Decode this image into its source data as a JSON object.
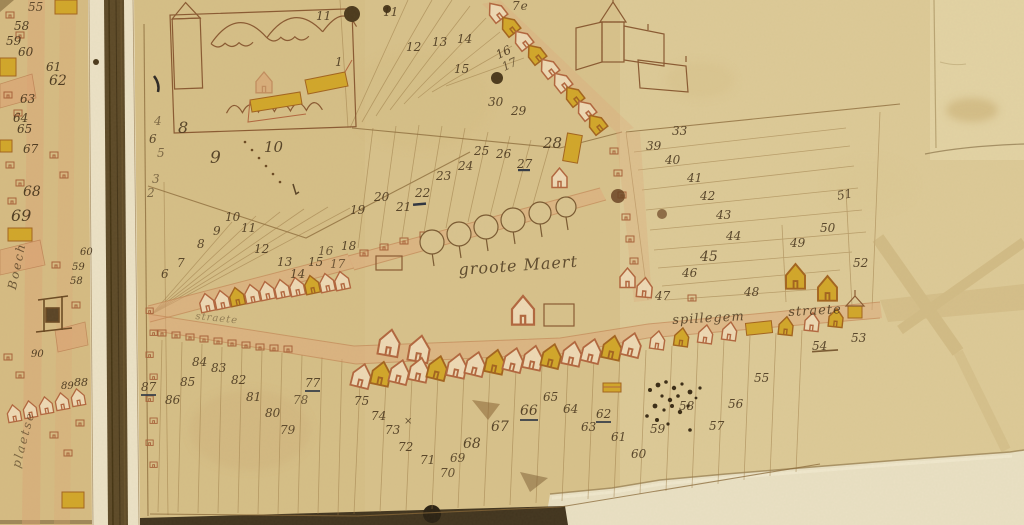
{
  "map": {
    "kind": "manuscript-cadastral-map",
    "labels": [
      {
        "t": "groote Maert",
        "x": 458,
        "y": 262,
        "s": 16,
        "r": -4,
        "cls": "pl"
      },
      {
        "t": "spillegem",
        "x": 672,
        "y": 314,
        "s": 13,
        "r": -3,
        "cls": "pl"
      },
      {
        "t": "straete",
        "x": 788,
        "y": 306,
        "s": 13,
        "r": -3,
        "cls": "pl"
      },
      {
        "t": "straete",
        "x": 196,
        "y": 312,
        "s": 10,
        "r": 6,
        "o": 0.45,
        "cls": "pl"
      },
      {
        "t": "Boech",
        "x": 6,
        "y": 288,
        "s": 12,
        "r": -78,
        "cls": "plv"
      },
      {
        "t": "plaetse",
        "x": 10,
        "y": 466,
        "s": 12,
        "r": -75,
        "o": 0.6,
        "cls": "plv"
      },
      {
        "t": "7e",
        "x": 512,
        "y": 0,
        "s": 12,
        "cls": "pl"
      },
      {
        "t": "1",
        "x": 335,
        "y": 56
      },
      {
        "t": "6",
        "x": 149,
        "y": 133
      },
      {
        "t": "4",
        "x": 154,
        "y": 115,
        "o": 0.6
      },
      {
        "t": "5",
        "x": 157,
        "y": 147,
        "o": 0.6
      },
      {
        "t": "3",
        "x": 152,
        "y": 173,
        "o": 0.6
      },
      {
        "t": "2",
        "x": 147,
        "y": 187,
        "o": 0.6
      },
      {
        "t": "8",
        "x": 178,
        "y": 120,
        "s": 16
      },
      {
        "t": "9",
        "x": 210,
        "y": 150,
        "s": 17
      },
      {
        "t": "10",
        "x": 264,
        "y": 140,
        "s": 15
      },
      {
        "t": "7",
        "x": 177,
        "y": 257
      },
      {
        "t": "6",
        "x": 161,
        "y": 268
      },
      {
        "t": "8",
        "x": 197,
        "y": 238
      },
      {
        "t": "9",
        "x": 213,
        "y": 225
      },
      {
        "t": "10",
        "x": 225,
        "y": 211
      },
      {
        "t": "11",
        "x": 241,
        "y": 222
      },
      {
        "t": "12",
        "x": 254,
        "y": 243
      },
      {
        "t": "13",
        "x": 277,
        "y": 256
      },
      {
        "t": "14",
        "x": 290,
        "y": 268
      },
      {
        "t": "15",
        "x": 308,
        "y": 256
      },
      {
        "t": "16",
        "x": 318,
        "y": 245,
        "o": 0.7
      },
      {
        "t": "17",
        "x": 330,
        "y": 258,
        "o": 0.7
      },
      {
        "t": "18",
        "x": 341,
        "y": 240
      },
      {
        "t": "19",
        "x": 350,
        "y": 204
      },
      {
        "t": "20",
        "x": 374,
        "y": 191
      },
      {
        "t": "21",
        "x": 396,
        "y": 201
      },
      {
        "t": "22",
        "x": 415,
        "y": 187
      },
      {
        "t": "23",
        "x": 436,
        "y": 170
      },
      {
        "t": "24",
        "x": 458,
        "y": 160
      },
      {
        "t": "25",
        "x": 474,
        "y": 145
      },
      {
        "t": "26",
        "x": 496,
        "y": 148
      },
      {
        "t": "27",
        "x": 517,
        "y": 158
      },
      {
        "t": "28",
        "x": 543,
        "y": 136,
        "s": 15
      },
      {
        "t": "30",
        "x": 488,
        "y": 96
      },
      {
        "t": "29",
        "x": 511,
        "y": 105
      },
      {
        "t": "11",
        "x": 316,
        "y": 10
      },
      {
        "t": "11",
        "x": 383,
        "y": 6
      },
      {
        "t": "12",
        "x": 406,
        "y": 41
      },
      {
        "t": "13",
        "x": 432,
        "y": 36
      },
      {
        "t": "14",
        "x": 457,
        "y": 33
      },
      {
        "t": "15",
        "x": 454,
        "y": 63
      },
      {
        "t": "16",
        "x": 494,
        "y": 50,
        "r": -25
      },
      {
        "t": "17",
        "x": 500,
        "y": 62,
        "r": -25,
        "o": 0.7
      },
      {
        "t": "33",
        "x": 672,
        "y": 125
      },
      {
        "t": "39",
        "x": 646,
        "y": 140
      },
      {
        "t": "40",
        "x": 665,
        "y": 154
      },
      {
        "t": "41",
        "x": 687,
        "y": 172
      },
      {
        "t": "42",
        "x": 700,
        "y": 190
      },
      {
        "t": "43",
        "x": 716,
        "y": 209
      },
      {
        "t": "44",
        "x": 726,
        "y": 230
      },
      {
        "t": "45",
        "x": 700,
        "y": 250,
        "s": 14
      },
      {
        "t": "46",
        "x": 682,
        "y": 267
      },
      {
        "t": "47",
        "x": 655,
        "y": 290
      },
      {
        "t": "48",
        "x": 744,
        "y": 286
      },
      {
        "t": "49",
        "x": 790,
        "y": 237
      },
      {
        "t": "50",
        "x": 820,
        "y": 222
      },
      {
        "t": "51",
        "x": 836,
        "y": 190,
        "r": -10
      },
      {
        "t": "52",
        "x": 853,
        "y": 257
      },
      {
        "t": "53",
        "x": 851,
        "y": 332
      },
      {
        "t": "54",
        "x": 812,
        "y": 340
      },
      {
        "t": "55",
        "x": 754,
        "y": 372
      },
      {
        "t": "56",
        "x": 728,
        "y": 398
      },
      {
        "t": "57",
        "x": 709,
        "y": 420
      },
      {
        "t": "58",
        "x": 679,
        "y": 400
      },
      {
        "t": "59",
        "x": 650,
        "y": 423
      },
      {
        "t": "60",
        "x": 631,
        "y": 448
      },
      {
        "t": "61",
        "x": 611,
        "y": 431
      },
      {
        "t": "62",
        "x": 596,
        "y": 408,
        "u": true
      },
      {
        "t": "63",
        "x": 581,
        "y": 421
      },
      {
        "t": "64",
        "x": 563,
        "y": 403
      },
      {
        "t": "65",
        "x": 543,
        "y": 391
      },
      {
        "t": "66",
        "x": 520,
        "y": 404,
        "s": 14,
        "u": true
      },
      {
        "t": "67",
        "x": 491,
        "y": 420,
        "s": 14
      },
      {
        "t": "68",
        "x": 463,
        "y": 437,
        "s": 14
      },
      {
        "t": "69",
        "x": 450,
        "y": 452,
        "o": 0.8
      },
      {
        "t": "70",
        "x": 440,
        "y": 467,
        "o": 0.8
      },
      {
        "t": "71",
        "x": 420,
        "y": 454
      },
      {
        "t": "72",
        "x": 398,
        "y": 441
      },
      {
        "t": "73",
        "x": 385,
        "y": 424
      },
      {
        "t": "74",
        "x": 371,
        "y": 410
      },
      {
        "t": "75",
        "x": 354,
        "y": 395
      },
      {
        "t": "77",
        "x": 305,
        "y": 377,
        "u": true
      },
      {
        "t": "78",
        "x": 293,
        "y": 394,
        "o": 0.7
      },
      {
        "t": "79",
        "x": 280,
        "y": 424,
        "o": 0.8
      },
      {
        "t": "80",
        "x": 265,
        "y": 407
      },
      {
        "t": "81",
        "x": 246,
        "y": 391
      },
      {
        "t": "82",
        "x": 231,
        "y": 374
      },
      {
        "t": "83",
        "x": 211,
        "y": 362
      },
      {
        "t": "84",
        "x": 192,
        "y": 356
      },
      {
        "t": "85",
        "x": 180,
        "y": 376
      },
      {
        "t": "86",
        "x": 165,
        "y": 394
      },
      {
        "t": "87",
        "x": 141,
        "y": 381,
        "u": true
      },
      {
        "t": "×",
        "x": 404,
        "y": 417,
        "cls": "mk"
      },
      {
        "t": "55",
        "x": 28,
        "y": 1,
        "o": 0.8,
        "cls": "nl"
      },
      {
        "t": "58",
        "x": 14,
        "y": 20,
        "cls": "nl"
      },
      {
        "t": "59",
        "x": 6,
        "y": 35,
        "cls": "nl"
      },
      {
        "t": "60",
        "x": 18,
        "y": 46,
        "cls": "nl"
      },
      {
        "t": "61",
        "x": 46,
        "y": 61,
        "cls": "nl"
      },
      {
        "t": "62",
        "x": 49,
        "y": 74,
        "s": 14,
        "cls": "nl"
      },
      {
        "t": "63",
        "x": 20,
        "y": 93,
        "cls": "nl"
      },
      {
        "t": "64",
        "x": 13,
        "y": 112,
        "cls": "nl"
      },
      {
        "t": "65",
        "x": 17,
        "y": 123,
        "cls": "nl"
      },
      {
        "t": "67",
        "x": 23,
        "y": 143,
        "cls": "nl"
      },
      {
        "t": "68",
        "x": 23,
        "y": 185,
        "s": 14,
        "cls": "nl"
      },
      {
        "t": "69",
        "x": 11,
        "y": 208,
        "s": 16,
        "cls": "nl"
      },
      {
        "t": "60",
        "x": 80,
        "y": 248,
        "s": 10,
        "cls": "nl"
      },
      {
        "t": "59",
        "x": 72,
        "y": 263,
        "s": 10,
        "cls": "nl"
      },
      {
        "t": "58",
        "x": 70,
        "y": 277,
        "s": 10,
        "cls": "nl"
      },
      {
        "t": "90",
        "x": 31,
        "y": 350,
        "s": 10,
        "cls": "nl"
      },
      {
        "t": "89",
        "x": 61,
        "y": 382,
        "s": 10,
        "cls": "nl"
      },
      {
        "t": "88",
        "x": 74,
        "y": 377,
        "s": 11,
        "cls": "nl"
      }
    ]
  },
  "colors": {
    "parchment": "#d8c28b",
    "parchmentlight": "#e6d8ac",
    "patch": "#eae1c4",
    "seamcream": "#ece2c6",
    "seamdark": "#5d4a28",
    "ink": "#7a5a32",
    "inkdark": "#43311a",
    "redline": "#b2673f",
    "redwash": "#dda072",
    "yellow": "#d2a72a",
    "street": "#dfa97c",
    "blob": "#4c3a1d"
  }
}
